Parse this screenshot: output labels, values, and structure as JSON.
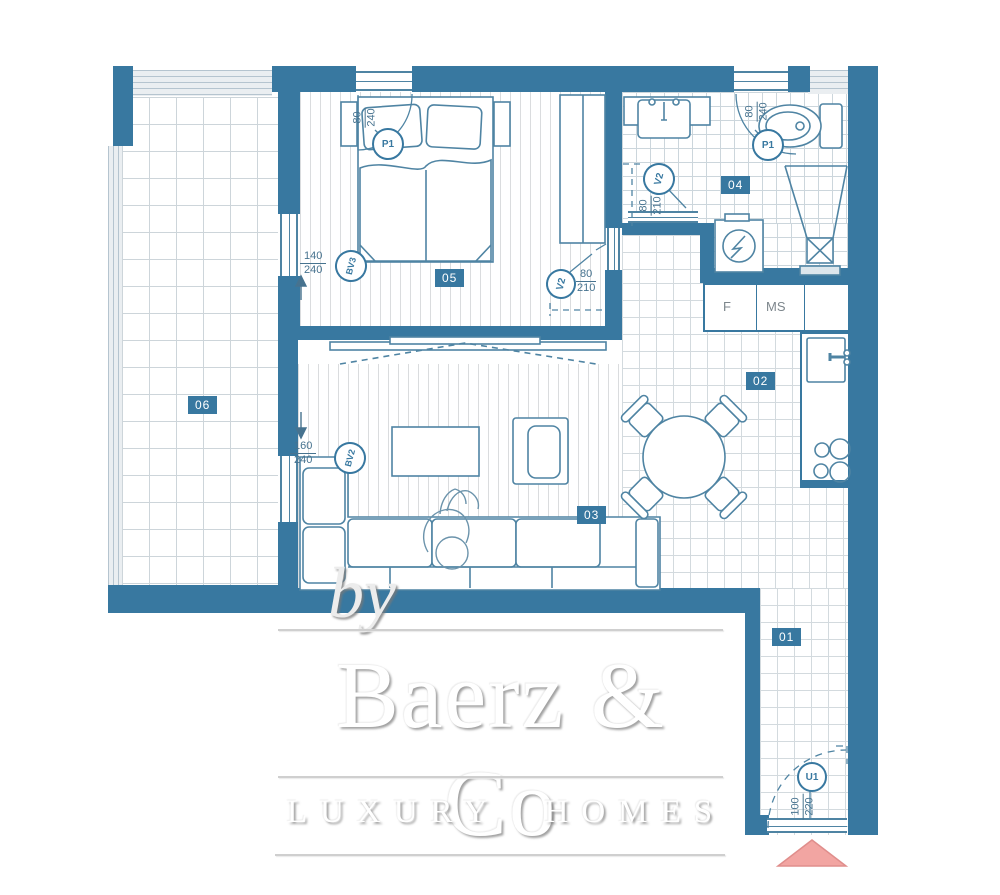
{
  "brand": {
    "by": "by",
    "name": "Baerz & Co",
    "tagline": "LUXURY HOMES"
  },
  "rooms": {
    "hall": "01",
    "kitchen": "02",
    "living": "03",
    "bathroom": "04",
    "bedroom": "05",
    "terrace": "06"
  },
  "doors": {
    "bedroom_balcony": {
      "label": "P1",
      "width": "80",
      "height": "240"
    },
    "bathroom_entry": {
      "label": "P1",
      "width": "80",
      "height": "240"
    },
    "bathroom_sliding": {
      "label": "V2",
      "width": "80",
      "height": "210"
    },
    "bedroom_door": {
      "label": "V2",
      "width": "80",
      "height": "210"
    },
    "bedroom_terrace": {
      "label": "BV3",
      "width": "140",
      "height": "240"
    },
    "living_terrace": {
      "label": "BV2",
      "width": "160",
      "height": "240"
    },
    "entrance": {
      "label": "U1",
      "width": "100",
      "height": "220"
    }
  },
  "kitchen": {
    "appliance_f": "F",
    "appliance_ms": "MS"
  },
  "colors": {
    "wall": "#3878a0",
    "furniture_line": "#4f84a3",
    "dimension_text": "#47738f",
    "entrance_marker": "#f2a5a2"
  }
}
